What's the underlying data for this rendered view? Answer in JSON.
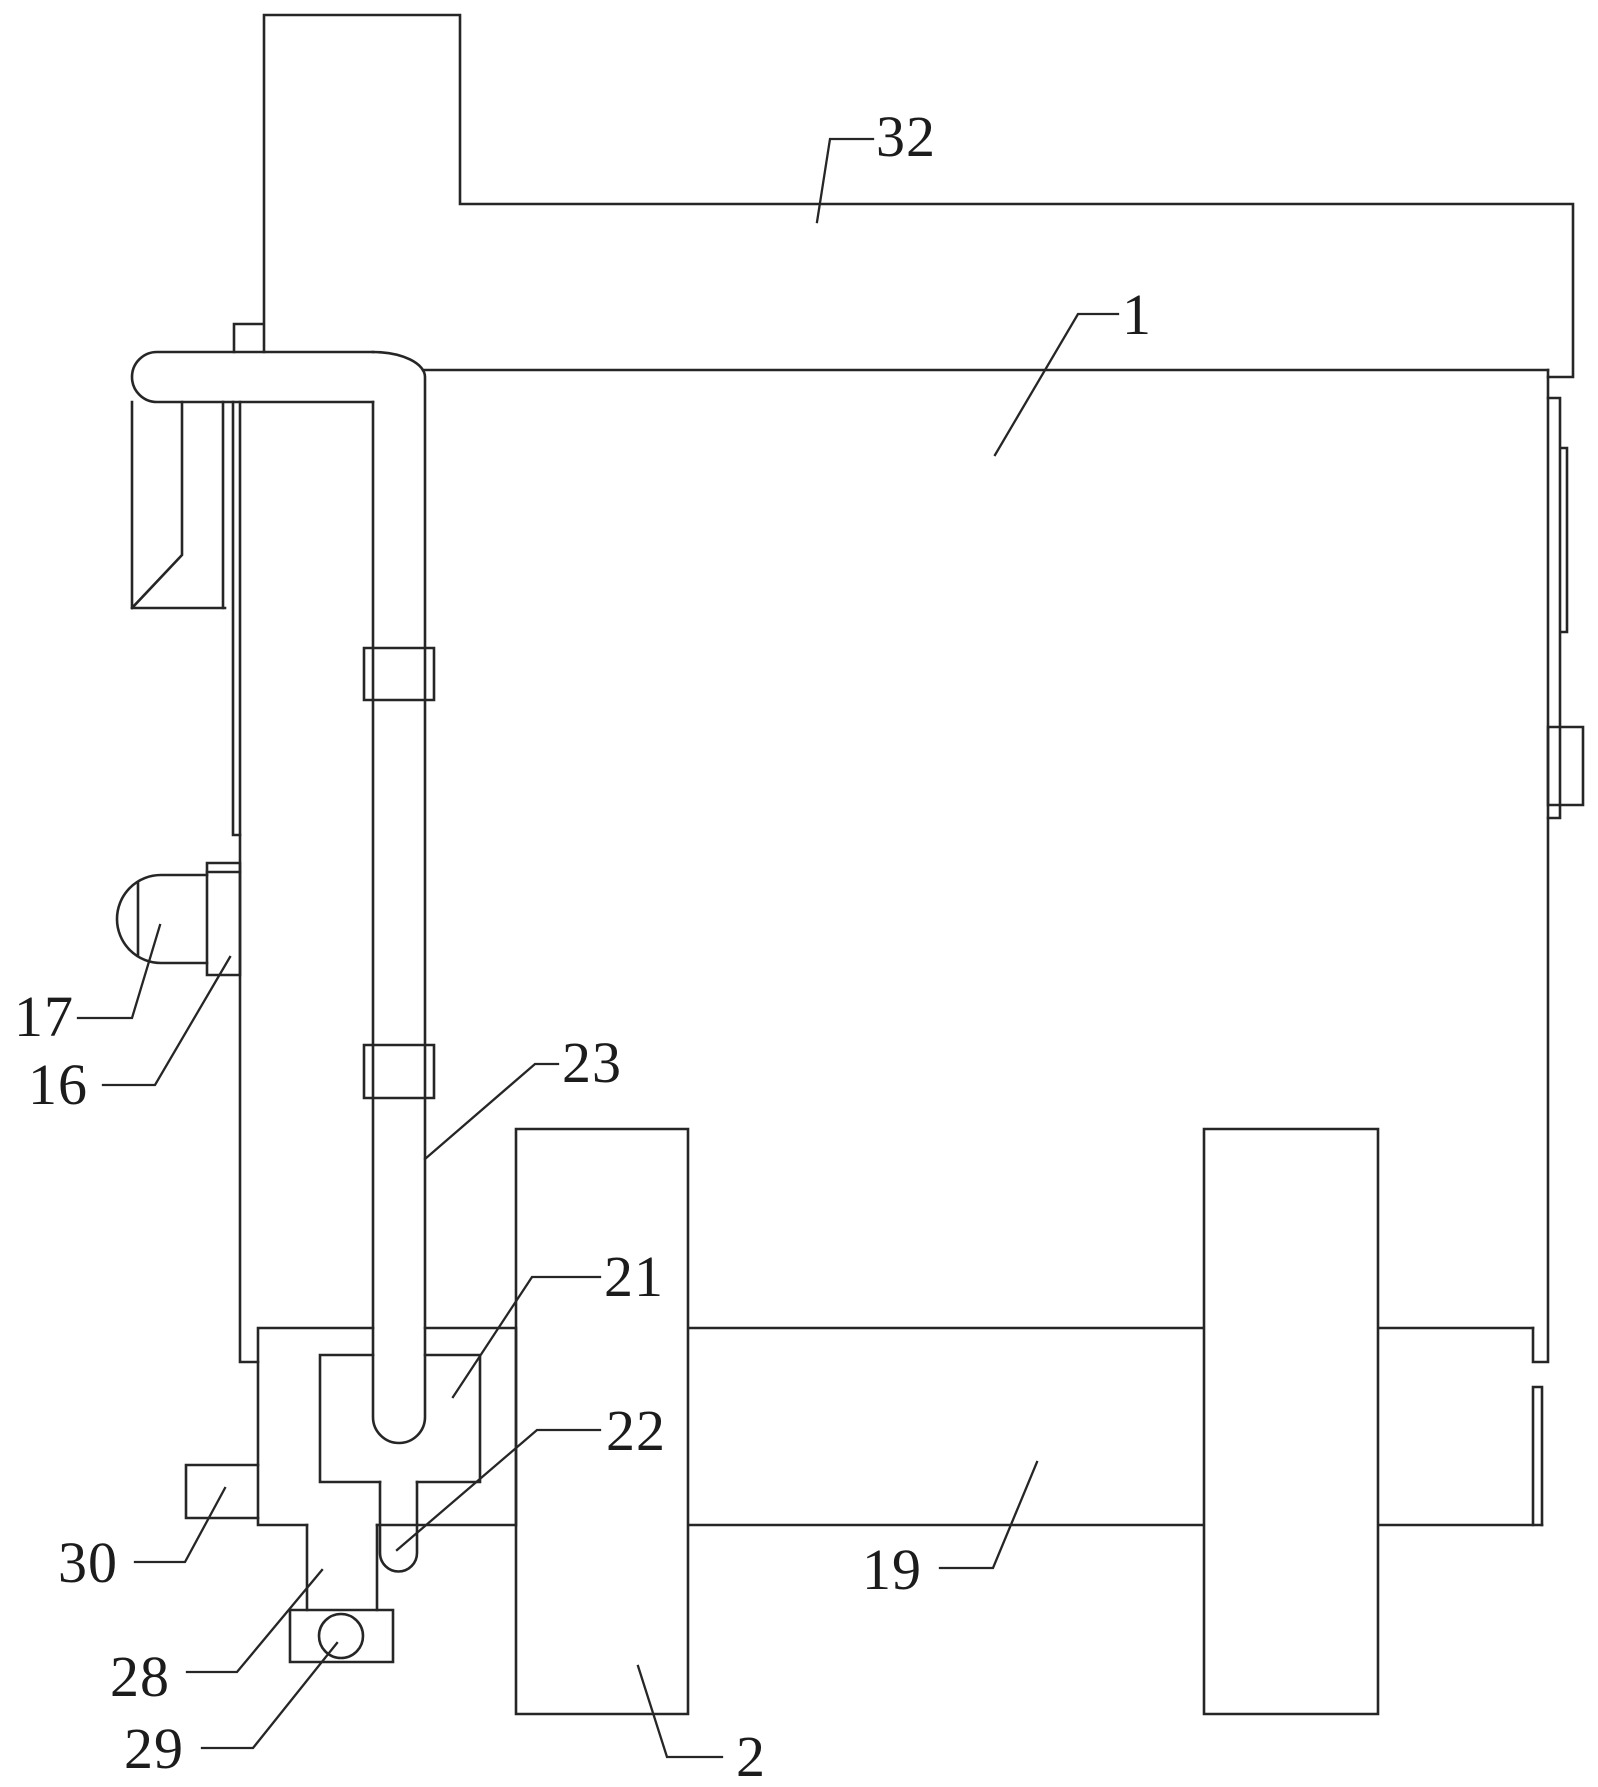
{
  "figure": {
    "background": "#ffffff",
    "line_color": "#262626",
    "callouts": {
      "c32": {
        "text": "32"
      },
      "c1": {
        "text": "1"
      },
      "c17": {
        "text": "17"
      },
      "c16": {
        "text": "16"
      },
      "c23": {
        "text": "23"
      },
      "c21": {
        "text": "21"
      },
      "c22": {
        "text": "22"
      },
      "c30": {
        "text": "30"
      },
      "c28": {
        "text": "28"
      },
      "c29": {
        "text": "29"
      },
      "c19": {
        "text": "19"
      },
      "c2": {
        "text": "2"
      }
    }
  }
}
